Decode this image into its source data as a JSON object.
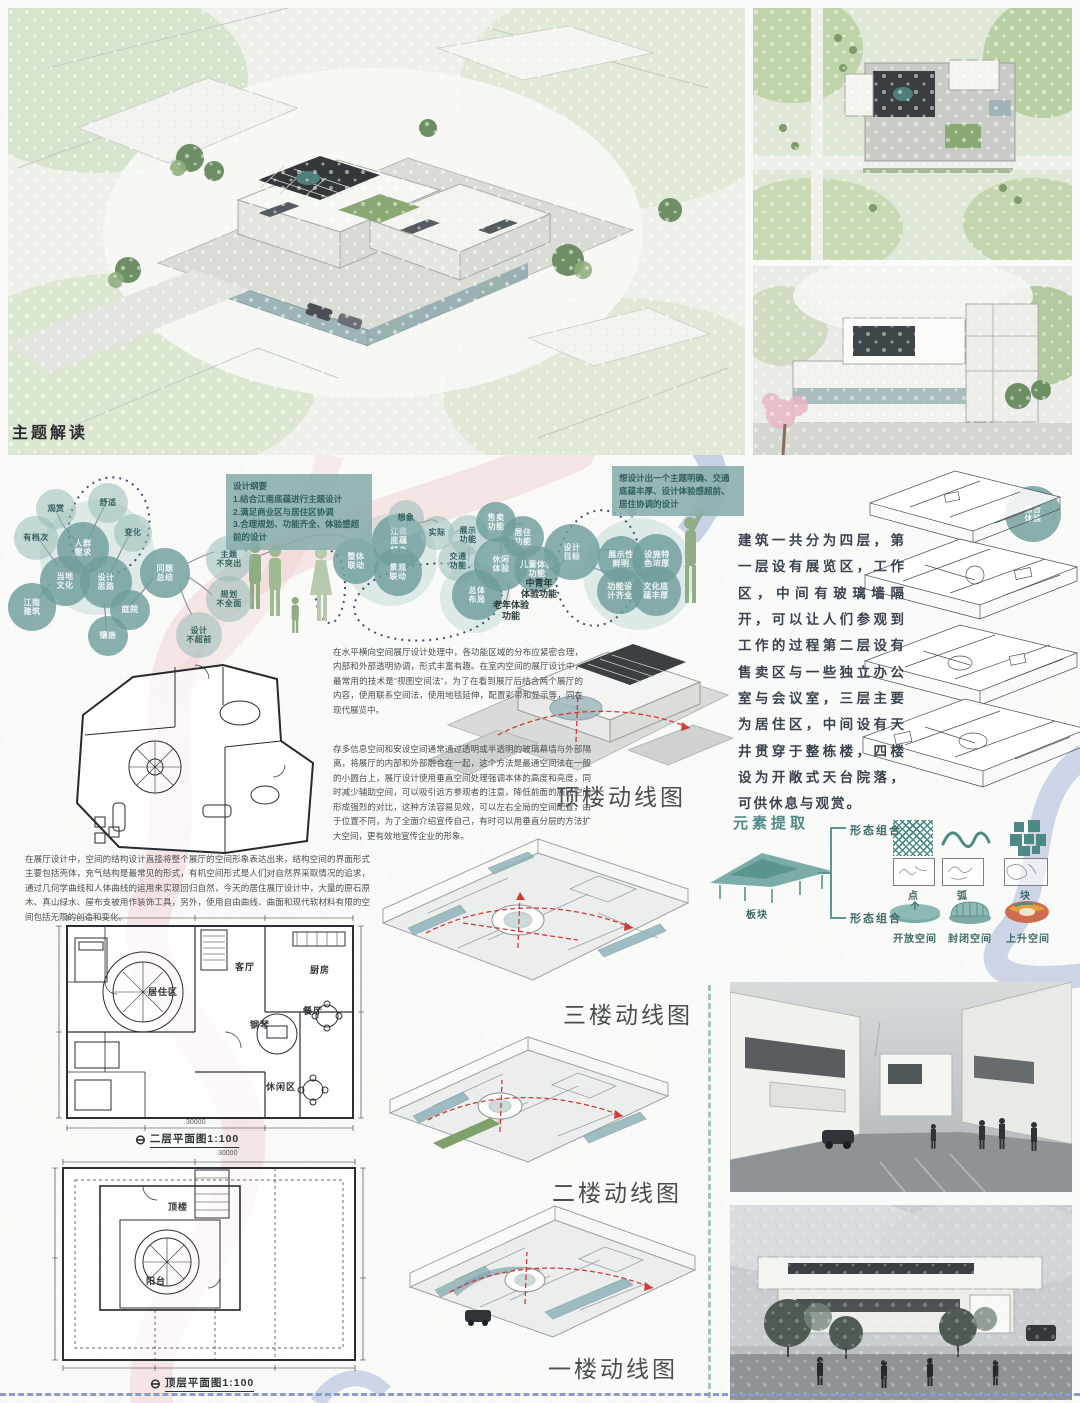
{
  "section_title": "主题解读",
  "notes": {
    "design_outline": "设计纲要\n1.结合江南底蕴进行主题设计\n2.满足商业区与居住区协调\n3.合理规划、功能齐全、体验感超前的设计",
    "design_goal": "想设计出一个主题明确、交通底蕴丰厚、设计体验感超前、居住协调的设计"
  },
  "bubbles": [
    {
      "label": "观赏"
    },
    {
      "label": "舒适"
    },
    {
      "label": "变化"
    },
    {
      "label": "有档次"
    },
    {
      "label": "人群\n需求"
    },
    {
      "label": "当地\n文化"
    },
    {
      "label": "设计\n思路"
    },
    {
      "label": "庭院"
    },
    {
      "label": "江南\n建筑"
    },
    {
      "label": "镶嵌"
    },
    {
      "label": "问题\n总结"
    },
    {
      "label": "主题\n不突出"
    },
    {
      "label": "规划\n不全面"
    },
    {
      "label": "设计\n不超前"
    },
    {
      "label": "整体\n联动"
    },
    {
      "label": "江南\n底蕴\n特色"
    },
    {
      "label": "景观\n联动"
    },
    {
      "label": "想象"
    },
    {
      "label": "实际"
    },
    {
      "label": "展示\n功能"
    },
    {
      "label": "售卖\n功能"
    },
    {
      "label": "居住\n功能"
    },
    {
      "label": "交通\n功能"
    },
    {
      "label": "休闲\n体验"
    },
    {
      "label": "儿童体验\n功能"
    },
    {
      "label": "总体\n布局"
    },
    {
      "label": "设计\n目标"
    },
    {
      "label": "展示性\n鲜明"
    },
    {
      "label": "设施特\n色浓厚"
    },
    {
      "label": "功能设\n计齐全"
    },
    {
      "label": "文化底\n蕴丰厚"
    },
    {
      "label": "综合\n体验"
    }
  ],
  "text_labels": {
    "mid_youth": "中青年\n体验功能",
    "elderly": "老年体验\n功能"
  },
  "paragraphs": {
    "building_intro": "建筑一共分为四层，第一层设有展览区，工作区，中间有玻璃墙隔开，可以让人们参观到工作的过程第二层设有售卖区与一些独立办公室与会议室，三层主要为居住区，中间设有天井贯穿于整栋楼，四楼设为开敞式天台院落，可供休息与观赏。",
    "exhibit_note_a": "在水平横向空间展厅设计处理中，各功能区域的分布应紧密合理，内部和外部透明协调，形式丰富有趣。在室内空间的展厅设计中，最常用的技术是“视图空间法”，为了在看到展厅后结合两个展厅的内容，使用联系空间法，使用地毯延伸，配置彩带和显示等，同在现代展览中。",
    "exhibit_note_b": "存多信息空间和安设空间通常通过透明或半透明的玻璃幕墙与外部隔离，将展厅的内部和外部融合在一起，这个方法是最通空间法在一般的小圆台上，展厅设计使用垂直空间处理强调本体的高度和亮度，同时减少辅助空间，可以吸引远方参观者的注意，降低前面的展厅空间形成强烈的对比，这种方法容易见效，可以左右全局的空间配置，由于位置不同，为了全面介绍宣传自己，有时可以用垂直分层的方法扩大空间，更有效地宣传企业的形象。",
    "exhibit_note_c": "在展厅设计中，空间的结构设计直接将整个展厅的空间形象表达出来，结构空间的界面形式主要包括壳体，充气结构是最常见的形式，有机空间形式是人们对自然界采取情况的追求，通过几何学曲线和人体曲线的运用来实现回归自然，今天的居住展厅设计中，大量的原石原木、真山绿水、屋布支被用作装饰工具，另外，使用自由曲线、曲面和现代软材料有限的空间包括无限的创造和变化。"
  },
  "circulation_labels": {
    "roof": "顶楼动线图",
    "third": "三楼动线图",
    "second": "二楼动线图",
    "first": "一楼动线图"
  },
  "plan_captions": {
    "second_floor": "二层平面图1:100",
    "top_floor": "顶层平面图1:100",
    "scale_symbol": "⊖"
  },
  "plan_rooms": {
    "living_zone": "居住区",
    "living_room": "客厅",
    "kitchen": "厨房",
    "dining": "餐厅",
    "piano": "钢琴",
    "leisure": "休闲区",
    "roof": "顶楼",
    "balcony": "阳台"
  },
  "plan_dims": {
    "plan2f_bottom": "30000",
    "plantop_top": "30000"
  },
  "element_extraction": {
    "title": "元素提取",
    "group_top": "形态组合",
    "group_bottom": "形态组合",
    "plate_label": "板块",
    "shape_labels": [
      "点",
      "弧",
      "块"
    ],
    "space_labels": [
      "开放空间",
      "封闭空间",
      "上升空间"
    ]
  },
  "colors": {
    "teal": "#4d8a86",
    "bubble_teal": "#6f9e9b",
    "pink_ribbon": "#eec6c9",
    "blue_ribbon": "#9fb0d6",
    "red_circulation": "#d23b35"
  }
}
